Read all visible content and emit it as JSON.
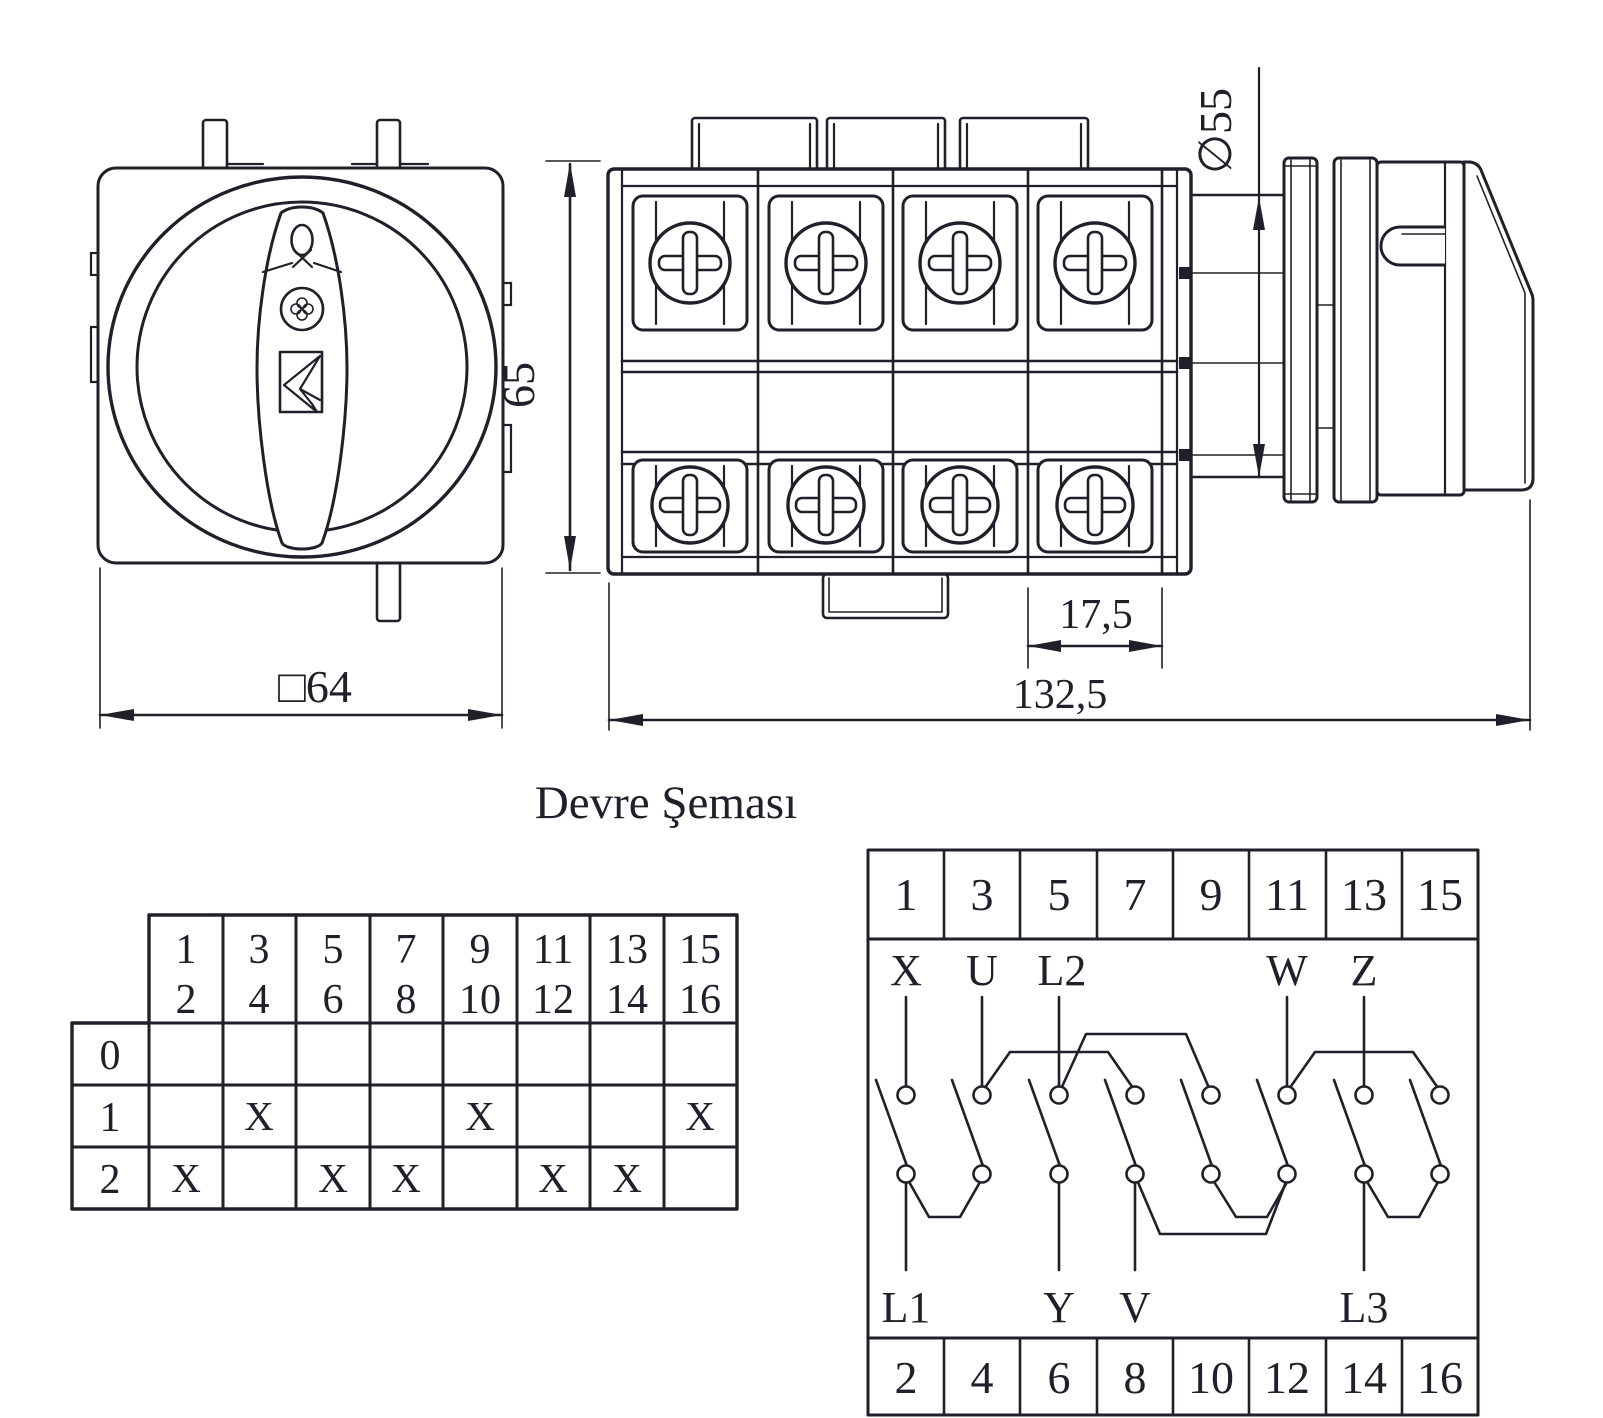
{
  "title": "Devre Şeması",
  "dims": {
    "front_width": "□64",
    "height": "65",
    "pitch": "17,5",
    "total_length": "132,5",
    "knob_diameter": "∅55"
  },
  "table": {
    "columns": [
      {
        "top": "1",
        "bottom": "2"
      },
      {
        "top": "3",
        "bottom": "4"
      },
      {
        "top": "5",
        "bottom": "6"
      },
      {
        "top": "7",
        "bottom": "8"
      },
      {
        "top": "9",
        "bottom": "10"
      },
      {
        "top": "11",
        "bottom": "12"
      },
      {
        "top": "13",
        "bottom": "14"
      },
      {
        "top": "15",
        "bottom": "16"
      }
    ],
    "rows": [
      {
        "label": "0",
        "cells": [
          "",
          "",
          "",
          "",
          "",
          "",
          "",
          ""
        ]
      },
      {
        "label": "1",
        "cells": [
          "",
          "X",
          "",
          "",
          "X",
          "",
          "",
          "X"
        ]
      },
      {
        "label": "2",
        "cells": [
          "X",
          "",
          "X",
          "X",
          "",
          "X",
          "X",
          ""
        ]
      }
    ]
  },
  "diagram": {
    "top_terminals": [
      "1",
      "3",
      "5",
      "7",
      "9",
      "11",
      "13",
      "15"
    ],
    "bottom_terminals": [
      "2",
      "4",
      "6",
      "8",
      "10",
      "12",
      "14",
      "16"
    ],
    "top_labels": [
      "X",
      "U",
      "L2",
      "W",
      "Z"
    ],
    "bottom_labels": [
      "L1",
      "Y",
      "V",
      "L3"
    ]
  }
}
